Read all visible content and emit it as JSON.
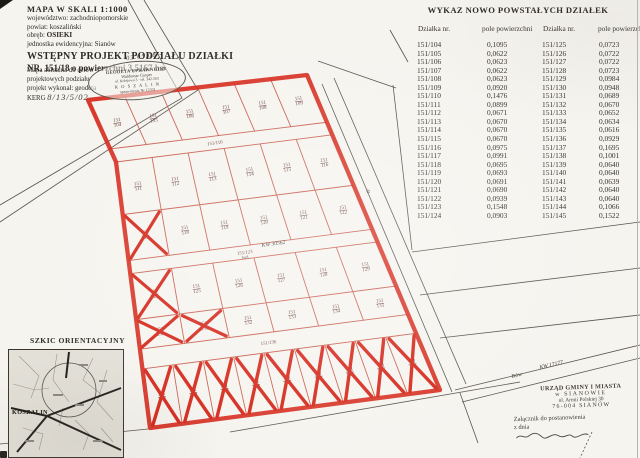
{
  "title_block": {
    "scale_line": "MAPA W SKALI  1:1000",
    "voivodeship_label": "województwo:",
    "voivodeship": "zachodniopomorskie",
    "county_label": "powiat:",
    "county": "koszaliński",
    "district_label": "obręb:",
    "district": "OSIEKI",
    "unit_label": "jednostka ewidencyjna:",
    "unit": "Sianów",
    "project_title": "WSTĘPNY  PROJEKT  PODZIAŁU  DZIAŁKI",
    "project_subtitle": "NR. 151/18  o powierzchni 3,5167 ha",
    "note_line1": "Mapa aktualna do celów",
    "note_line2": "projektowych podziału",
    "note_line3": "projekt wykonał: geodeta",
    "kerg_label": "KERG",
    "kerg_value": "8/13/5/02",
    "surveyor_stamp": {
      "line1": "GEODETA UPRAWNIONY",
      "line2": "Waldemar Gasper",
      "line3": "ul. Kolejowa 3 · tel. 342-563",
      "line4": "K O S Z A L I N",
      "line5": "uprawnienia Nr 12331",
      "handwritten_date": "03.05.08 -"
    }
  },
  "table": {
    "title": "WYKAZ  NOWO  POWSTAŁYCH  DZIAŁEK",
    "col_plot": "Działka  nr.",
    "col_area": "pole powierzchni",
    "left_rows": [
      [
        "151/104",
        "0,1095"
      ],
      [
        "151/105",
        "0,0622"
      ],
      [
        "151/106",
        "0,0623"
      ],
      [
        "151/107",
        "0,0622"
      ],
      [
        "151/108",
        "0,0623"
      ],
      [
        "151/109",
        "0,0920"
      ],
      [
        "151/110",
        "0,1476"
      ],
      [
        "151/111",
        "0,0899"
      ],
      [
        "151/112",
        "0,0671"
      ],
      [
        "151/113",
        "0,0670"
      ],
      [
        "151/114",
        "0,0670"
      ],
      [
        "151/115",
        "0,0670"
      ],
      [
        "151/116",
        "0,0975"
      ],
      [
        "151/117",
        "0,0991"
      ],
      [
        "151/118",
        "0,0695"
      ],
      [
        "151/119",
        "0,0693"
      ],
      [
        "151/120",
        "0,0691"
      ],
      [
        "151/121",
        "0,0690"
      ],
      [
        "151/122",
        "0,0939"
      ],
      [
        "151/123",
        "0,1548"
      ],
      [
        "151/124",
        "0,0903"
      ]
    ],
    "right_rows": [
      [
        "151/125",
        "0,0723"
      ],
      [
        "151/126",
        "0,0722"
      ],
      [
        "151/127",
        "0,0722"
      ],
      [
        "151/128",
        "0,0723"
      ],
      [
        "151/129",
        "0,0984"
      ],
      [
        "151/130",
        "0,0948"
      ],
      [
        "151/131",
        "0,0689"
      ],
      [
        "151/132",
        "0,0670"
      ],
      [
        "151/133",
        "0,0652"
      ],
      [
        "151/134",
        "0,0634"
      ],
      [
        "151/135",
        "0,0616"
      ],
      [
        "151/136",
        "0,0929"
      ],
      [
        "151/137",
        "0,1695"
      ],
      [
        "151/138",
        "0,1001"
      ],
      [
        "151/139",
        "0,0640"
      ],
      [
        "151/140",
        "0,0640"
      ],
      [
        "151/141",
        "0,0639"
      ],
      [
        "151/142",
        "0,0640"
      ],
      [
        "151/143",
        "0,0640"
      ],
      [
        "151/144",
        "0,1066"
      ],
      [
        "151/145",
        "0,1522"
      ]
    ]
  },
  "map": {
    "colors": {
      "boundary_red": "#d5281b",
      "grid_red": "#c95f50",
      "label_ink": "#6e4540",
      "black_line": "#4e4a44"
    },
    "rows": [
      {
        "kind": "plots",
        "labels": [
          "151/104",
          "151/105",
          "151/106",
          "151/107",
          "151/108",
          "151/109"
        ],
        "crossed": []
      },
      {
        "kind": "road",
        "label": "151/110"
      },
      {
        "kind": "plots",
        "labels": [
          "151/111",
          "151/112",
          "151/113",
          "151/114",
          "151/115",
          "151/116"
        ],
        "crossed": []
      },
      {
        "kind": "plots",
        "labels": [
          "151/117",
          "151/118",
          "151/119",
          "151/120",
          "151/121",
          "151/122"
        ],
        "crossed": [
          0
        ]
      },
      {
        "kind": "road",
        "label": "151/123"
      },
      {
        "kind": "plots",
        "labels": [
          "151/124",
          "151/125",
          "151/126",
          "151/127",
          "151/128",
          "151/129"
        ],
        "crossed": [
          0
        ]
      },
      {
        "kind": "plots",
        "labels": [
          "151/130",
          "151/131",
          "151/132",
          "151/133",
          "151/134",
          "151/135"
        ],
        "crossed": [
          0,
          1
        ]
      },
      {
        "kind": "road",
        "label": "151/136"
      },
      {
        "kind": "plots",
        "labels": [
          "151/137",
          "151/138",
          "151/139",
          "151/140",
          "151/141",
          "151/142",
          "151/143",
          "151/144",
          "151/145"
        ],
        "crossed": [
          0,
          1,
          2,
          3,
          4,
          5,
          6,
          7,
          8
        ]
      }
    ],
    "annotations": {
      "kw_road": "KW 30562",
      "kw_ditch": "KW 17177",
      "ditch_label": "Rów",
      "road_label": "dr.",
      "building_label": "bud."
    }
  },
  "inset": {
    "title": "SZKIC ORIENTACYJNY",
    "city": "KOSZALIN"
  },
  "office_stamp": {
    "line1": "URZĄD GMINY I MIASTA",
    "line2": "w SIANOWIE",
    "line3": "ul. Armii Polskiej 30",
    "line4": "76-004  SIANÓW",
    "attachment_line1": "Załącznik do postanowienia",
    "attachment_line2": "z dnia"
  }
}
